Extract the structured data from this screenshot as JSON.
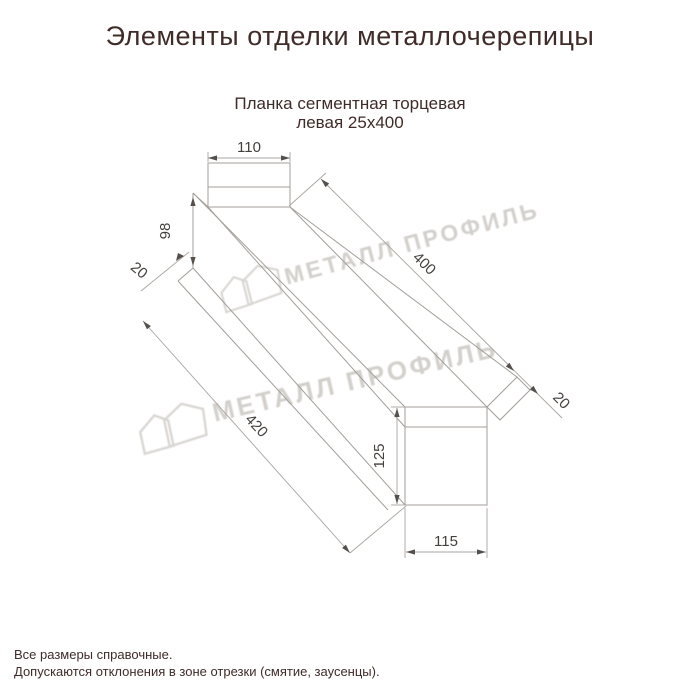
{
  "header": {
    "title": "Элементы отделки металлочерепицы"
  },
  "drawing": {
    "subtitle_line1": "Планка сегментная торцевая",
    "subtitle_line2": "левая 25х400",
    "dims": {
      "top_width": "110",
      "web_height": "98",
      "top_hem": "20",
      "face_length": "400",
      "total_length": "420",
      "end_hem": "20",
      "end_height": "125",
      "end_width": "115"
    }
  },
  "watermark": {
    "text": "МЕТАЛЛ ПРОФИЛЬ"
  },
  "footer": {
    "line1": "Все размеры справочные.",
    "line2": "Допускаются отклонения в зоне отрезки (смятие, заусенцы)."
  },
  "colors": {
    "heading_text": "#3f2b27",
    "dimension_text": "#45403d",
    "drawing_line": "#a39e99",
    "watermark": "#d3d0cc",
    "background": "#ffffff"
  }
}
